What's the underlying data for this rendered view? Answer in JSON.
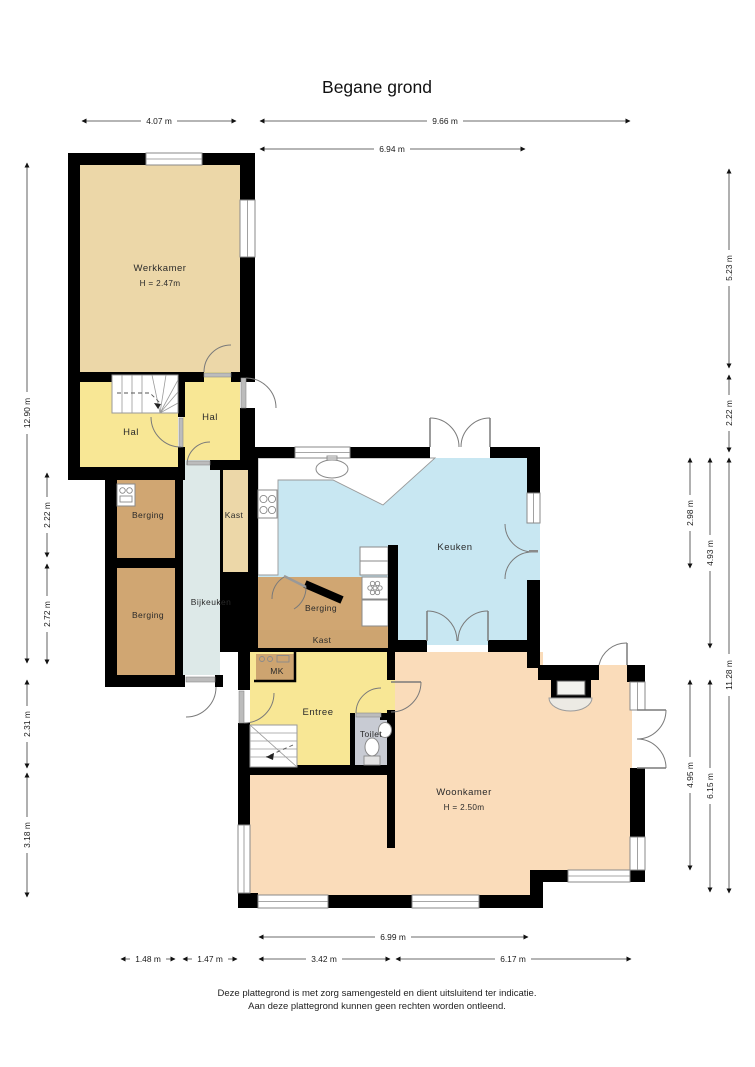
{
  "title": "Begane grond",
  "disclaimer": {
    "line1": "Deze plattegrond is met zorg samengesteld en dient uitsluitend ter indicatie.",
    "line2": "Aan deze plattegrond kunnen geen rechten worden ontleend."
  },
  "colors": {
    "wall": "#000000",
    "werkkamer": "#ecd7a8",
    "hal": "#f8e795",
    "berging": "#d0a672",
    "bijkeuken": "#dde9e8",
    "kast_tan": "#ecd7a8",
    "kast_brown": "#cda470",
    "keuken": "#c8e7f2",
    "woonkamer": "#fadcba",
    "toilet": "#c8cbd3",
    "entree": "#f8e795",
    "mk": "#cda470"
  },
  "rooms": {
    "werkkamer": {
      "label": "Werkkamer",
      "height": "H = 2.47m"
    },
    "hal_left": {
      "label": "Hal"
    },
    "hal_right": {
      "label": "Hal"
    },
    "berging_1": {
      "label": "Berging"
    },
    "berging_2": {
      "label": "Berging"
    },
    "bijkeuken": {
      "label": "Bijkeuken"
    },
    "kast_1": {
      "label": "Kast"
    },
    "keuken": {
      "label": "Keuken"
    },
    "berging_3": {
      "label": "Berging"
    },
    "kast_2": {
      "label": "Kast"
    },
    "mk": {
      "label": "MK"
    },
    "entree": {
      "label": "Entree"
    },
    "toilet": {
      "label": "Toilet"
    },
    "woonkamer": {
      "label": "Woonkamer",
      "height": "H = 2.50m"
    }
  },
  "dimensions": {
    "top": {
      "d1": "4.07 m",
      "d2": "9.66 m",
      "d3": "6.94 m"
    },
    "bottom": {
      "d1": "6.99 m",
      "d2": "1.48 m",
      "d3": "1.47 m",
      "d4": "3.42 m",
      "d5": "6.17 m"
    },
    "left": {
      "d1": "12.90 m",
      "d2": "2.22 m",
      "d3": "2.72 m",
      "d4": "2.31 m",
      "d5": "3.18 m"
    },
    "right": {
      "d1": "5.23 m",
      "d2": "2.22 m",
      "d3": "2.98 m",
      "d4": "4.93 m",
      "d5": "11.28 m",
      "d6": "4.95 m",
      "d7": "6.15 m"
    }
  }
}
